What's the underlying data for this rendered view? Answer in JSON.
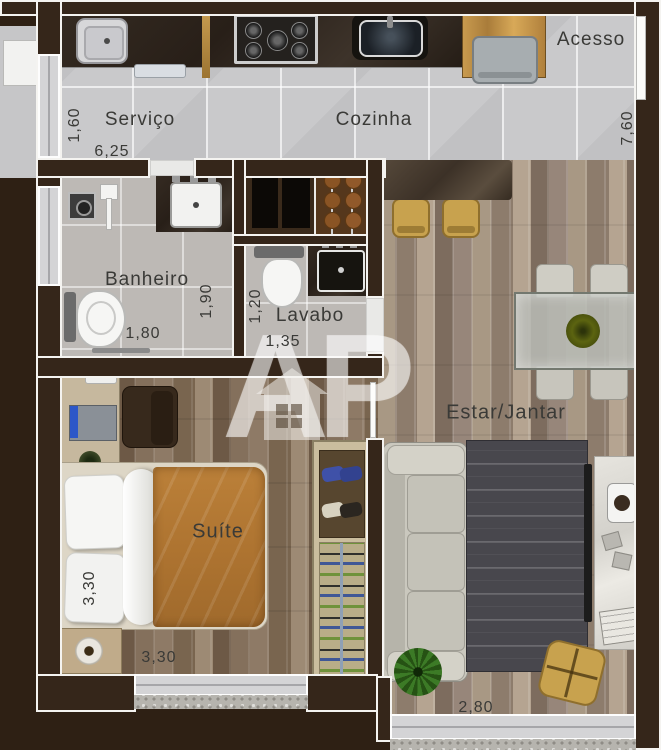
{
  "plan": {
    "watermark_text": "AP",
    "rooms": {
      "acesso": {
        "label": "Acesso"
      },
      "servico": {
        "label": "Serviço",
        "dim_width": "1,60",
        "dim_length": "6,25"
      },
      "cozinha": {
        "label": "Cozinha"
      },
      "right_side": {
        "dim_depth": "7,60"
      },
      "banheiro": {
        "label": "Banheiro",
        "dim_width": "1,80",
        "dim_depth": "1,90"
      },
      "lavabo": {
        "label": "Lavabo",
        "dim_depth": "1,20",
        "dim_width": "1,35"
      },
      "suite": {
        "label": "Suíte",
        "dim_width": "3,30",
        "dim_length": "3,30"
      },
      "estar_jantar": {
        "label": "Estar/Jantar",
        "dim_window": "2,80"
      }
    },
    "furniture": [
      "laundry-sink",
      "drying-rack",
      "stove",
      "kitchen-sink",
      "entry-desk",
      "entry-chair",
      "bar-counter",
      "bar-stool",
      "bar-stool",
      "closet-cabinet",
      "pantry-niche",
      "shower-drain",
      "shower-wand",
      "bathroom-vanity",
      "bathroom-toilet",
      "towel-bar",
      "lavabo-toilet",
      "lavabo-sink",
      "desk",
      "desk-chair",
      "laptop",
      "double-bed",
      "pillows",
      "nightstand",
      "lamp",
      "wardrobe-shoes",
      "wardrobe-clothes",
      "dining-table",
      "dining-chairs",
      "centerpiece",
      "sofa",
      "rug",
      "tv-console",
      "tv",
      "speaker",
      "pouf",
      "plant"
    ],
    "colors": {
      "background": "#2e2014",
      "wall_fill": "#35261a",
      "wall_outline": "#f4f3f0",
      "tile_floor": "#c9c9cb",
      "bath_floor": "#bdb9b5",
      "wood_living": "#9a8a7c",
      "wood_suite": "#83705f",
      "counter_dark": "#2b221a",
      "accent_yellow": "#c8a24e",
      "bed_orange": "#b57a35",
      "sofa_gray": "#c9c7bd",
      "rug_dark": "#48474d",
      "plant_green": "#3c7a26",
      "label_text": "#3a3a37"
    }
  }
}
